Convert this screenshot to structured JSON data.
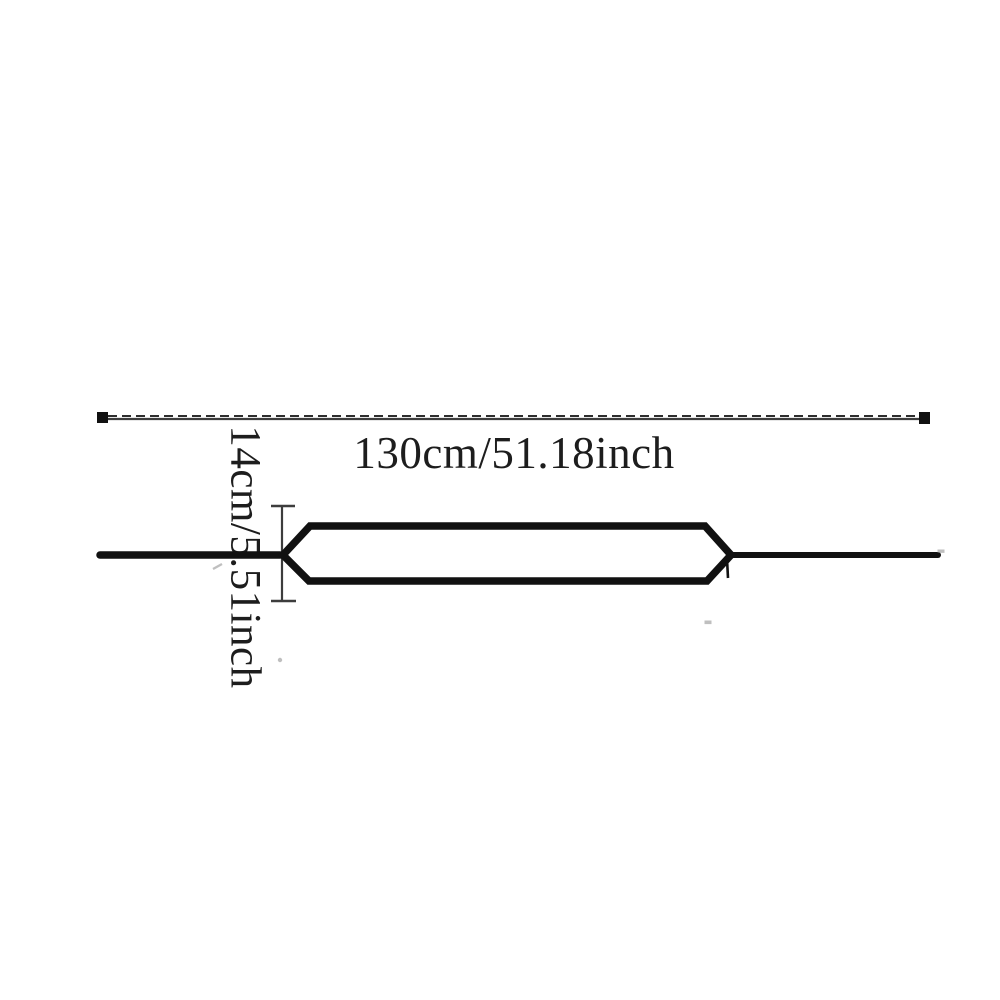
{
  "colors": {
    "background": "#ffffff",
    "ink": "#111111",
    "dim_line": "#3d3d3d",
    "label_text": "#1d1d1d",
    "artifact": "#8c8c8c"
  },
  "diagram": {
    "type": "product-dimension-diagram",
    "length_label": "130cm/51.18inch",
    "width_label": "14cm/5.51inch",
    "markers": {
      "length_endpoints": "filled-square-marker",
      "width_endpoints": "tick-bar-marker"
    }
  }
}
